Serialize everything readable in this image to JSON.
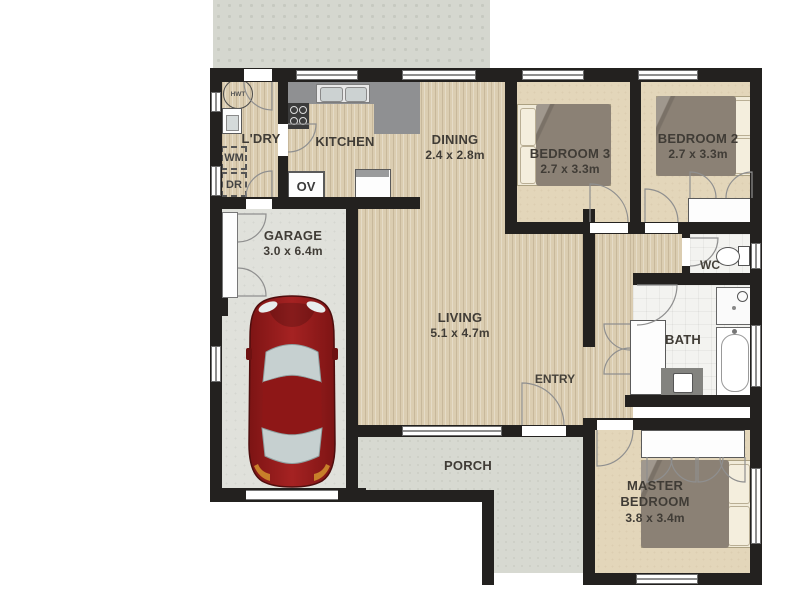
{
  "rooms": {
    "laundry": {
      "name": "L'DRY"
    },
    "kitchen": {
      "name": "KITCHEN"
    },
    "dining": {
      "name": "DINING",
      "dims": "2.4 x 2.8m"
    },
    "bedroom3": {
      "name": "BEDROOM 3",
      "dims": "2.7 x 3.3m"
    },
    "bedroom2": {
      "name": "BEDROOM 2",
      "dims": "2.7 x 3.3m"
    },
    "garage": {
      "name": "GARAGE",
      "dims": "3.0 x 6.4m"
    },
    "living": {
      "name": "LIVING",
      "dims": "5.1 x 4.7m"
    },
    "entry": {
      "name": "ENTRY"
    },
    "wc": {
      "name": "WC"
    },
    "bath": {
      "name": "BATH"
    },
    "master_bedroom": {
      "name": "MASTER BEDROOM",
      "dims": "3.8 x 3.4m"
    },
    "porch": {
      "name": "PORCH"
    }
  },
  "fixtures": {
    "hot_water_tank": "HWT",
    "washing_machine": "WM",
    "dryer": "DR",
    "oven": "OV"
  },
  "colors": {
    "wall": "#23211f",
    "wood_floor": "#dbcdb1",
    "carpet": "#e3d6ba",
    "garage_floor": "#e0e1db",
    "porch_concrete": "#d7d9d1",
    "patio": "#d5d7cf",
    "bathroom_tile": "#f3f3f0",
    "kitchen_counter": "#8f9092",
    "bed_duvet": "#8b8175",
    "car_body": "#8c1a1a",
    "label_text": "#403c36"
  }
}
